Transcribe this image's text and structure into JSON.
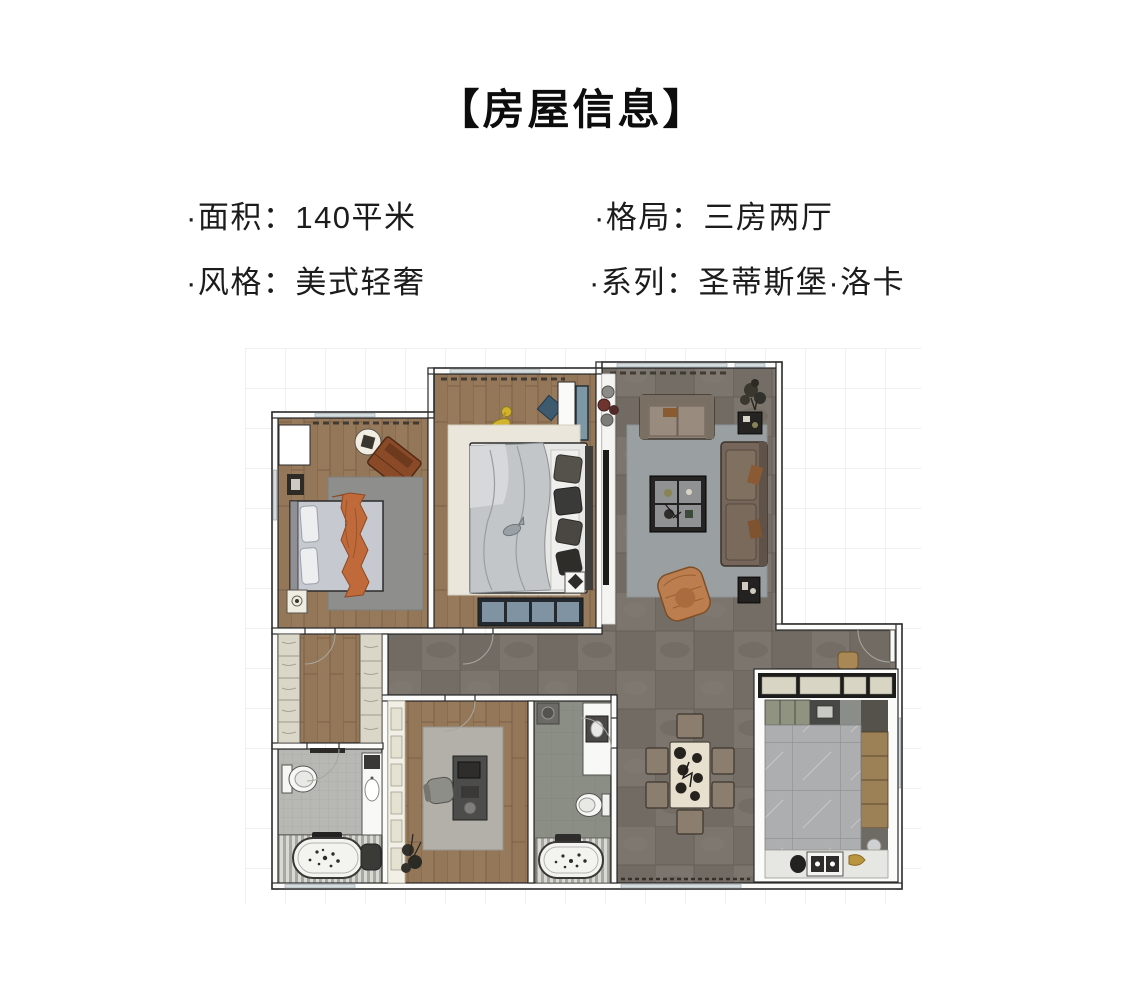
{
  "header": {
    "title": "【房屋信息】"
  },
  "info": {
    "area": {
      "label": "面积",
      "value": "140平米",
      "text": "·面积：140平米"
    },
    "layout": {
      "label": "格局",
      "value": "三房两厅",
      "text": "·格局：三房两厅"
    },
    "style": {
      "label": "风格",
      "value": "美式轻奢",
      "text": "·风格：美式轻奢"
    },
    "series": {
      "label": "系列",
      "value": "圣蒂斯堡·洛卡",
      "text": "·系列：圣蒂斯堡·洛卡"
    }
  },
  "floor_plan": {
    "type": "floor-plan",
    "rooms": [
      "master-bedroom",
      "second-bedroom",
      "living-room",
      "dining-area",
      "kitchen",
      "study",
      "bathroom-1",
      "bathroom-2",
      "hallway-wardrobe",
      "entry"
    ],
    "palette": {
      "text": "#1c1c1c",
      "wall-line": "#2b2b2b",
      "wood-floor": "#97795c",
      "tile-floor": "#7b756d",
      "kitchen-floor": "#adaeb0",
      "rug-gray": "#8e8e8c",
      "rug-cream": "#eae6db",
      "rug-living": "#9aa0a2",
      "sofa-tan": "#8d8174",
      "sofa-brown": "#75655a",
      "blanket-orange": "#c06a3c",
      "chair-orange": "#bd7e4f",
      "bench-blue": "#7f93a2",
      "giraffe-yellow": "#d2b32f",
      "cabinet-cream": "#dbd7c8",
      "table-cream": "#e7e0cf"
    }
  }
}
